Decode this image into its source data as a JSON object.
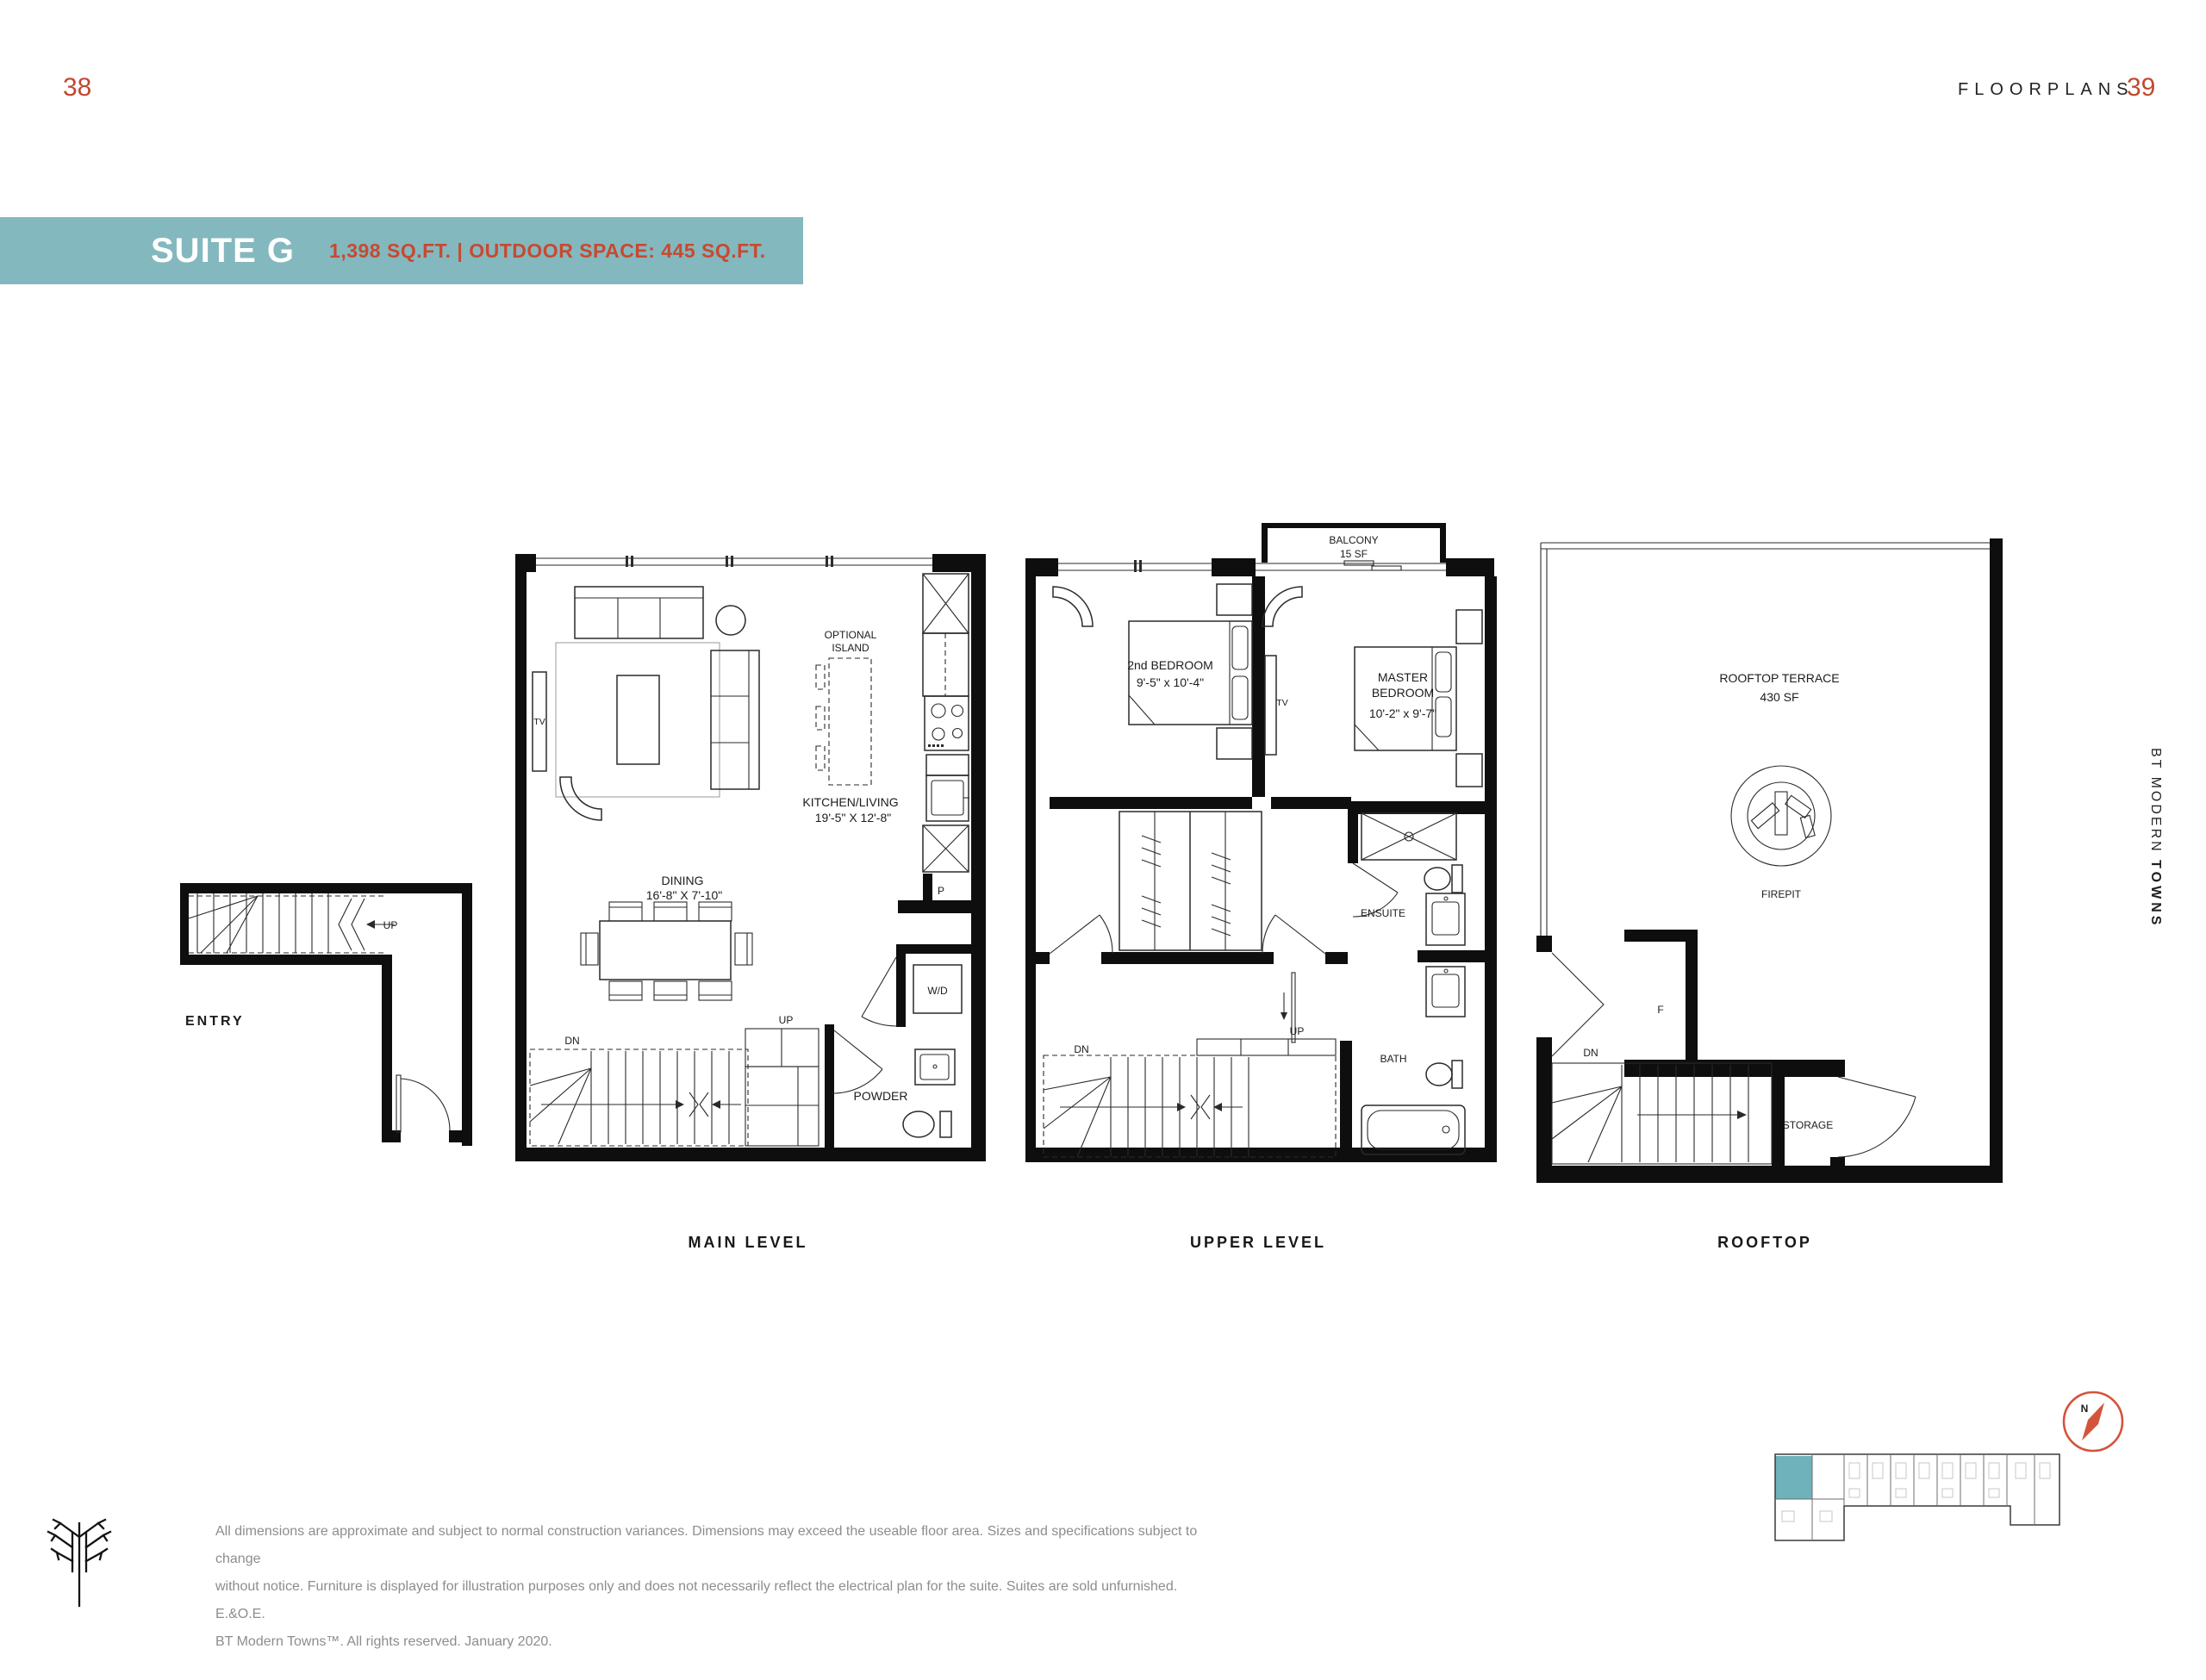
{
  "colors": {
    "accent_red": "#c1492f",
    "banner_teal": "#84b8bf",
    "keyplan_highlight": "#6fb2bb",
    "compass_orange": "#d4543a",
    "plan_black": "#0e0e0e",
    "disclaimer_gray": "#8d8d8d"
  },
  "page": {
    "left_number": "38",
    "right_number": "39",
    "section": "FLOORPLANS"
  },
  "banner": {
    "suite": "SUITE G",
    "specs": "1,398 SQ.FT. | OUTDOOR SPACE: 445 SQ.FT."
  },
  "entry_plan": {
    "label": "ENTRY",
    "up": "UP"
  },
  "main_level": {
    "caption": "MAIN LEVEL",
    "optional_island_1": "OPTIONAL",
    "optional_island_2": "ISLAND",
    "kitchen_living": "KITCHEN/LIVING",
    "kitchen_living_dims": "19'-5\" X 12'-8\"",
    "dining": "DINING",
    "dining_dims": "16'-8\" X 7'-10\"",
    "tv": "TV",
    "wd": "W/D",
    "powder": "POWDER",
    "pantry": "P",
    "dn": "DN",
    "up": "UP"
  },
  "upper_level": {
    "caption": "UPPER LEVEL",
    "balcony": "BALCONY",
    "balcony_area": "15 SF",
    "bedroom2": "2nd BEDROOM",
    "bedroom2_dims": "9'-5\" x 10'-4\"",
    "master_1": "MASTER",
    "master_2": "BEDROOM",
    "master_dims": "10'-2\" x 9'-7\"",
    "ensuite": "ENSUITE",
    "bath": "BATH",
    "tv": "TV",
    "dn": "DN",
    "up": "UP"
  },
  "rooftop": {
    "caption": "ROOFTOP",
    "terrace": "ROOFTOP TERRACE",
    "terrace_area": "430 SF",
    "firepit": "FIREPIT",
    "storage": "STORAGE",
    "closet_f": "F",
    "dn": "DN"
  },
  "sidebar": {
    "brand_light": "BT MODERN",
    "brand_bold": "TOWNS"
  },
  "compass": {
    "north": "N"
  },
  "footer": {
    "disclaimer_1": "All dimensions are approximate and subject to normal construction variances. Dimensions may exceed the useable floor area. Sizes and specifications subject to change",
    "disclaimer_2": "without notice. Furniture is displayed for illustration purposes only and does not necessarily reflect the electrical plan for the suite. Suites are sold unfurnished. E.&O.E.",
    "disclaimer_3": "BT Modern Towns™. All rights reserved. January 2020."
  }
}
